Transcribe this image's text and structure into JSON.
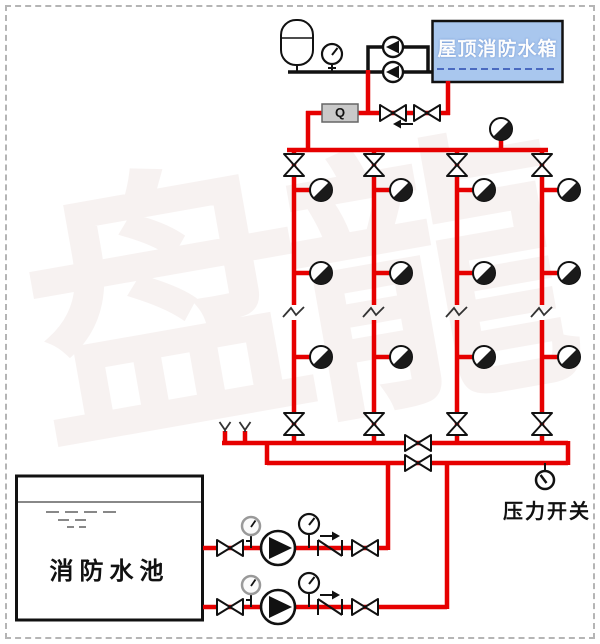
{
  "labels": {
    "roof_tank": "屋顶消防水箱",
    "fire_pool": "消防水池",
    "pressure_switch": "压力开关",
    "flow_meter": "Q"
  },
  "watermark": {
    "chars": [
      "盘",
      "龍"
    ]
  },
  "colors": {
    "pipe_red": "#e60000",
    "pipe_black": "#111111",
    "tank_fill": "#a9c7ee",
    "tank_water_line": "#2b4bb0",
    "pool_gray": "#888888",
    "meter_fill": "#c9c9c9",
    "border_dash": "#b5b5b5"
  },
  "icons": [
    "expansion-tank-icon",
    "pressure-gauge-icon",
    "stabilizer-pump-icon",
    "fire-pump-icon",
    "gate-valve-icon",
    "check-valve-icon",
    "flow-meter-icon",
    "signal-valve-icon",
    "sprinkler-icon",
    "air-vent-icon",
    "pipe-break-icon",
    "test-vent-icon",
    "pressure-switch-icon"
  ]
}
